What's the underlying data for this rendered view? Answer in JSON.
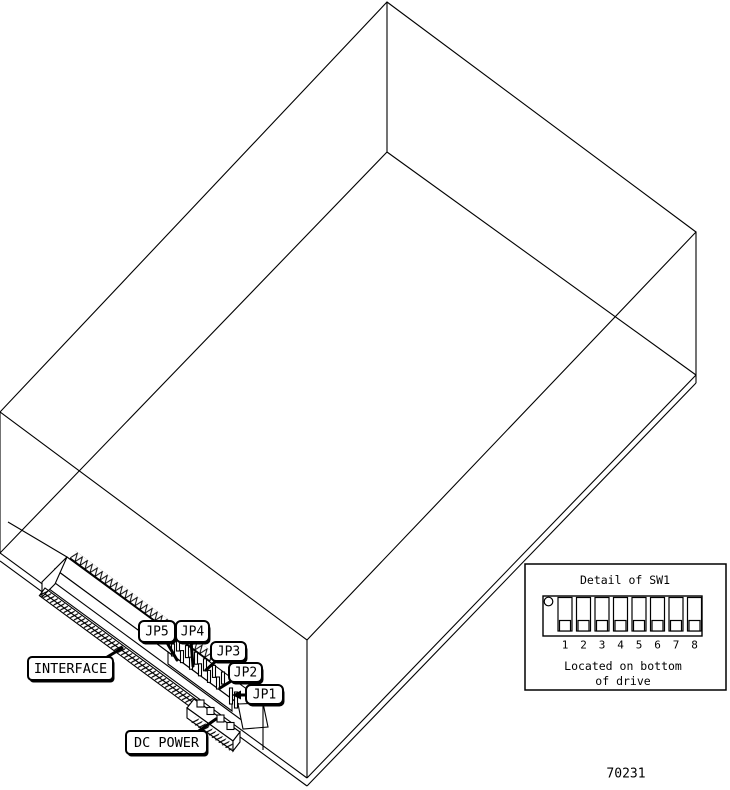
{
  "figure": {
    "callouts": {
      "interface": "INTERFACE",
      "dc_power": "DC POWER",
      "jp5": "JP5",
      "jp4": "JP4",
      "jp3": "JP3",
      "jp2": "JP2",
      "jp1": "JP1"
    },
    "detail_box": {
      "title": "Detail of SW1",
      "switch_numbers": [
        "1",
        "2",
        "3",
        "4",
        "5",
        "6",
        "7",
        "8"
      ],
      "note_line1": "Located on bottom",
      "note_line2": "of drive"
    },
    "part_number": "70231",
    "colors": {
      "line": "#000000",
      "background": "#ffffff"
    }
  }
}
